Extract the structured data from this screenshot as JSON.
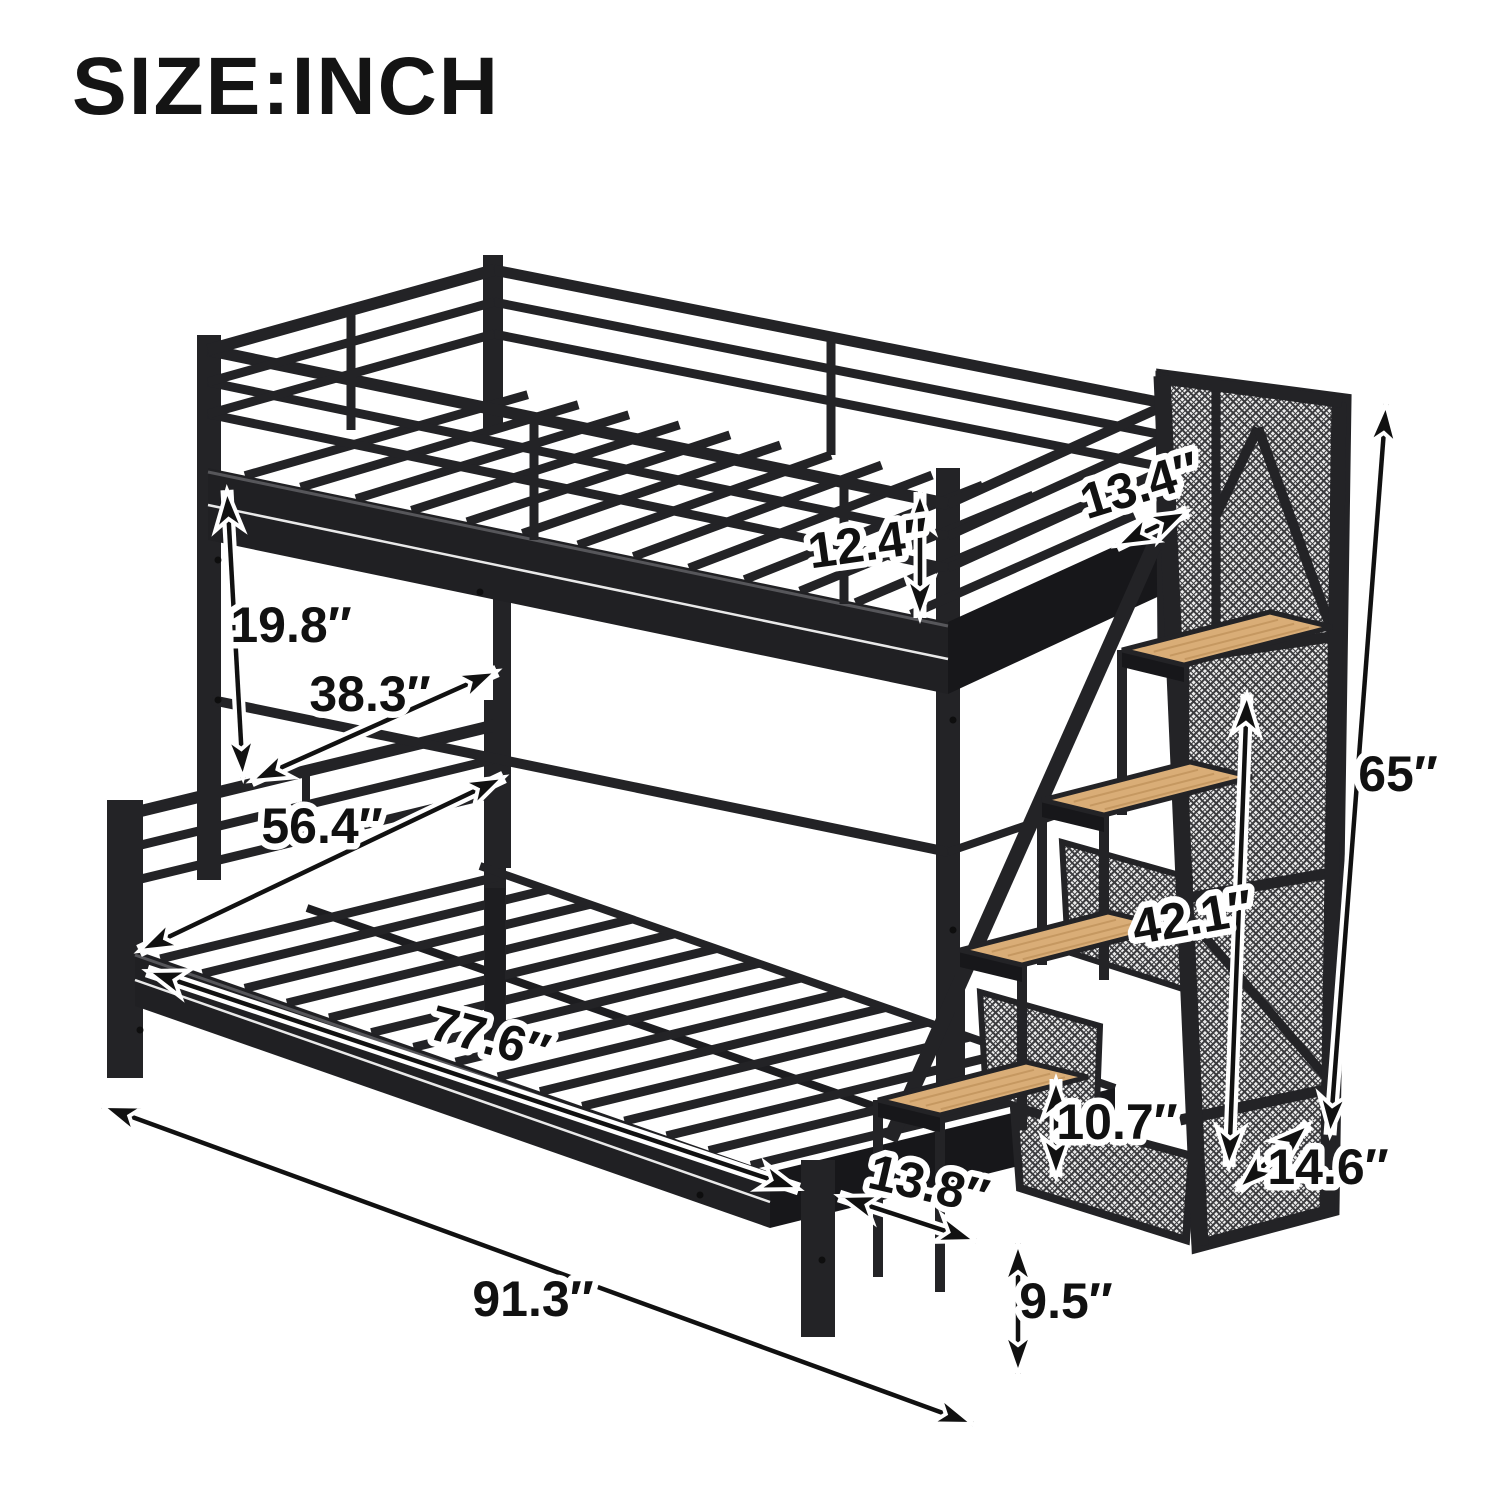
{
  "title": "SIZE:INCH",
  "unit": "inch",
  "colors": {
    "background": "#ffffff",
    "metal": "#232326",
    "metal_dark": "#17171a",
    "metal_mid": "#2e2e31",
    "metal_highlight": "#56565a",
    "metal_stripe": "#e9e9e9",
    "wood": "#d9ad77",
    "wood_grain": "#c2955e",
    "mesh_background": "#ededed",
    "mesh_wire": "#3a3a3d",
    "dimension_line": "#111111",
    "dimension_casing": "#ffffff",
    "text": "#141414"
  },
  "dimensions": [
    {
      "name": "upper-rail-depth",
      "value": 13.4,
      "unit": "in",
      "label": "13.4″",
      "arrow": {
        "x1": 1116,
        "y1": 546,
        "x2": 1188,
        "y2": 511
      },
      "label_pos": {
        "x": 1141,
        "y": 489,
        "rot": -17
      }
    },
    {
      "name": "upper-guardrail-height",
      "value": 12.4,
      "unit": "in",
      "label": "12.4″",
      "arrow": {
        "x1": 920,
        "y1": 492,
        "x2": 920,
        "y2": 618
      },
      "label_pos": {
        "x": 869,
        "y": 547,
        "rot": -8
      }
    },
    {
      "name": "bunk-gap-height",
      "value": 19.8,
      "unit": "in",
      "label": "19.8″",
      "arrow": {
        "x1": 227,
        "y1": 490,
        "x2": 243,
        "y2": 778
      },
      "label_pos": {
        "x": 291,
        "y": 629,
        "rot": 0
      }
    },
    {
      "name": "upper-bed-width",
      "value": 38.3,
      "unit": "in",
      "label": "38.3″",
      "arrow": {
        "x1": 251,
        "y1": 781,
        "x2": 497,
        "y2": 671
      },
      "label_pos": {
        "x": 370,
        "y": 698,
        "rot": 0
      }
    },
    {
      "name": "lower-bed-width",
      "value": 56.4,
      "unit": "in",
      "label": "56.4″",
      "arrow": {
        "x1": 139,
        "y1": 951,
        "x2": 504,
        "y2": 777
      },
      "label_pos": {
        "x": 322,
        "y": 830,
        "rot": 0
      }
    },
    {
      "name": "lower-bed-length",
      "value": 77.6,
      "unit": "in",
      "label": "77.6″",
      "arrow": {
        "x1": 147,
        "y1": 971,
        "x2": 799,
        "y2": 1189
      },
      "label_pos": {
        "x": 489,
        "y": 1041,
        "rot": 15
      }
    },
    {
      "name": "overall-length",
      "value": 91.3,
      "unit": "in",
      "label": "91.3″",
      "arrow": {
        "x1": 102,
        "y1": 1106,
        "x2": 973,
        "y2": 1424
      },
      "label_pos": {
        "x": 533,
        "y": 1303,
        "rot": 0
      }
    },
    {
      "name": "staircase-height",
      "value": 42.1,
      "unit": "in",
      "label": "42.1″",
      "arrow": {
        "x1": 1247,
        "y1": 694,
        "x2": 1229,
        "y2": 1167
      },
      "label_pos": {
        "x": 1193,
        "y": 921,
        "rot": -10
      }
    },
    {
      "name": "step-rise",
      "value": 10.7,
      "unit": "in",
      "label": "10.7″",
      "arrow": {
        "x1": 1056,
        "y1": 1079,
        "x2": 1056,
        "y2": 1177
      },
      "label_pos": {
        "x": 1117,
        "y": 1126,
        "rot": 0
      }
    },
    {
      "name": "step-depth",
      "value": 13.8,
      "unit": "in",
      "label": "13.8″",
      "arrow": {
        "x1": 839,
        "y1": 1196,
        "x2": 976,
        "y2": 1241
      },
      "label_pos": {
        "x": 928,
        "y": 1188,
        "rot": 13
      }
    },
    {
      "name": "leg-height",
      "value": 9.5,
      "unit": "in",
      "label": "9.5″",
      "arrow": {
        "x1": 1018,
        "y1": 1243,
        "x2": 1018,
        "y2": 1374
      },
      "label_pos": {
        "x": 1066,
        "y": 1305,
        "rot": 0
      }
    },
    {
      "name": "overall-height",
      "value": 65,
      "unit": "in",
      "label": "65″",
      "arrow": {
        "x1": 1386,
        "y1": 404,
        "x2": 1330,
        "y2": 1135
      },
      "label_pos": {
        "x": 1398,
        "y": 778,
        "rot": 0
      }
    },
    {
      "name": "staircase-depth",
      "value": 14.6,
      "unit": "in",
      "label": "14.6″",
      "arrow": {
        "x1": 1238,
        "y1": 1189,
        "x2": 1309,
        "y2": 1124
      },
      "label_pos": {
        "x": 1328,
        "y": 1171,
        "rot": 0
      }
    }
  ]
}
